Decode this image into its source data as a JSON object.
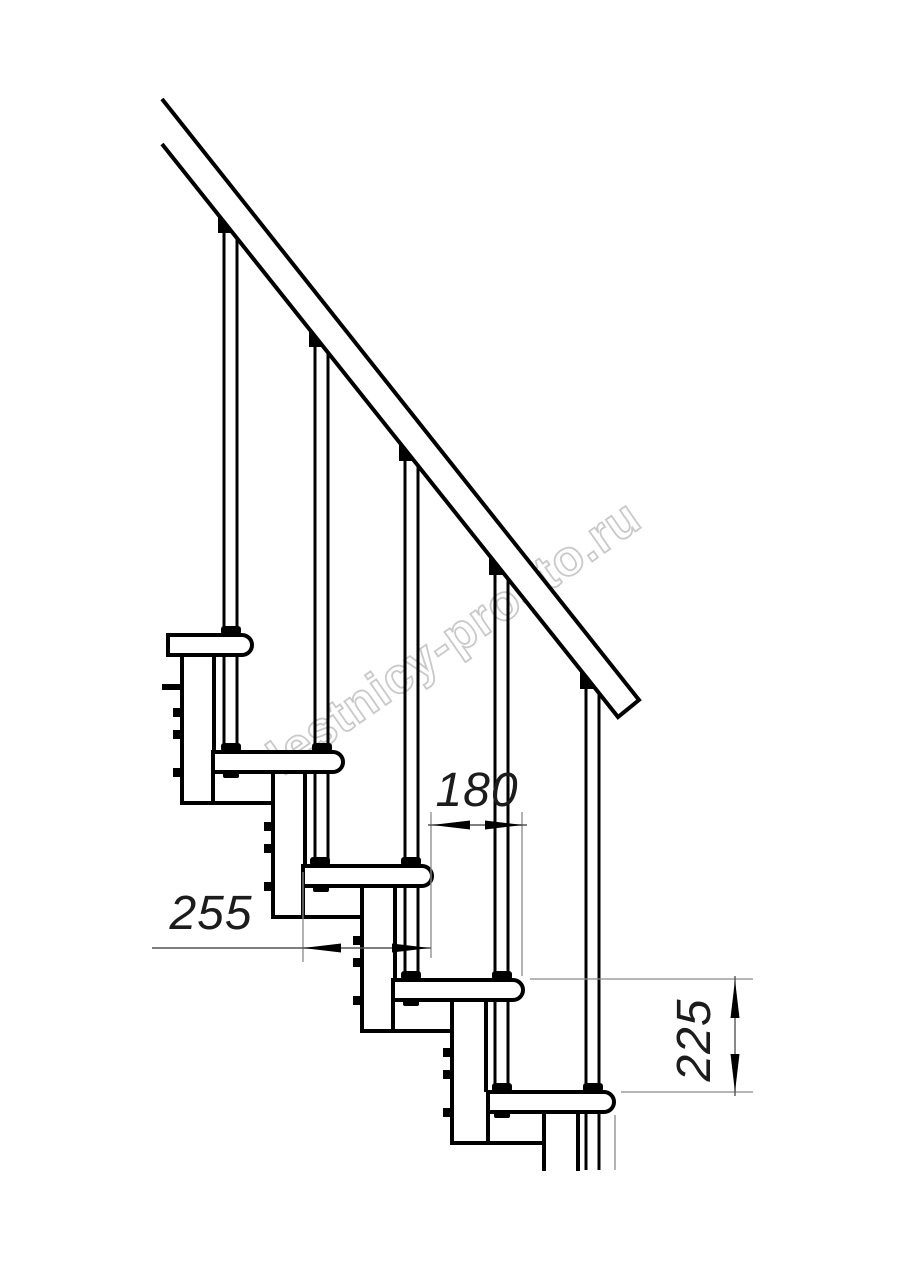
{
  "drawing": {
    "subject": "modular staircase side-view technical drawing",
    "steps_visible": 5,
    "balusters_visible": 5,
    "line_color": "#000000",
    "dimension_line_color": "#8a8a8a",
    "background_color": "#ffffff"
  },
  "watermark": {
    "text": "lestnicy-prosto.ru",
    "color": "#c9c9c9"
  },
  "dimensions": {
    "run": {
      "value": "180"
    },
    "tread": {
      "value": "255"
    },
    "rise": {
      "value": "225"
    }
  }
}
